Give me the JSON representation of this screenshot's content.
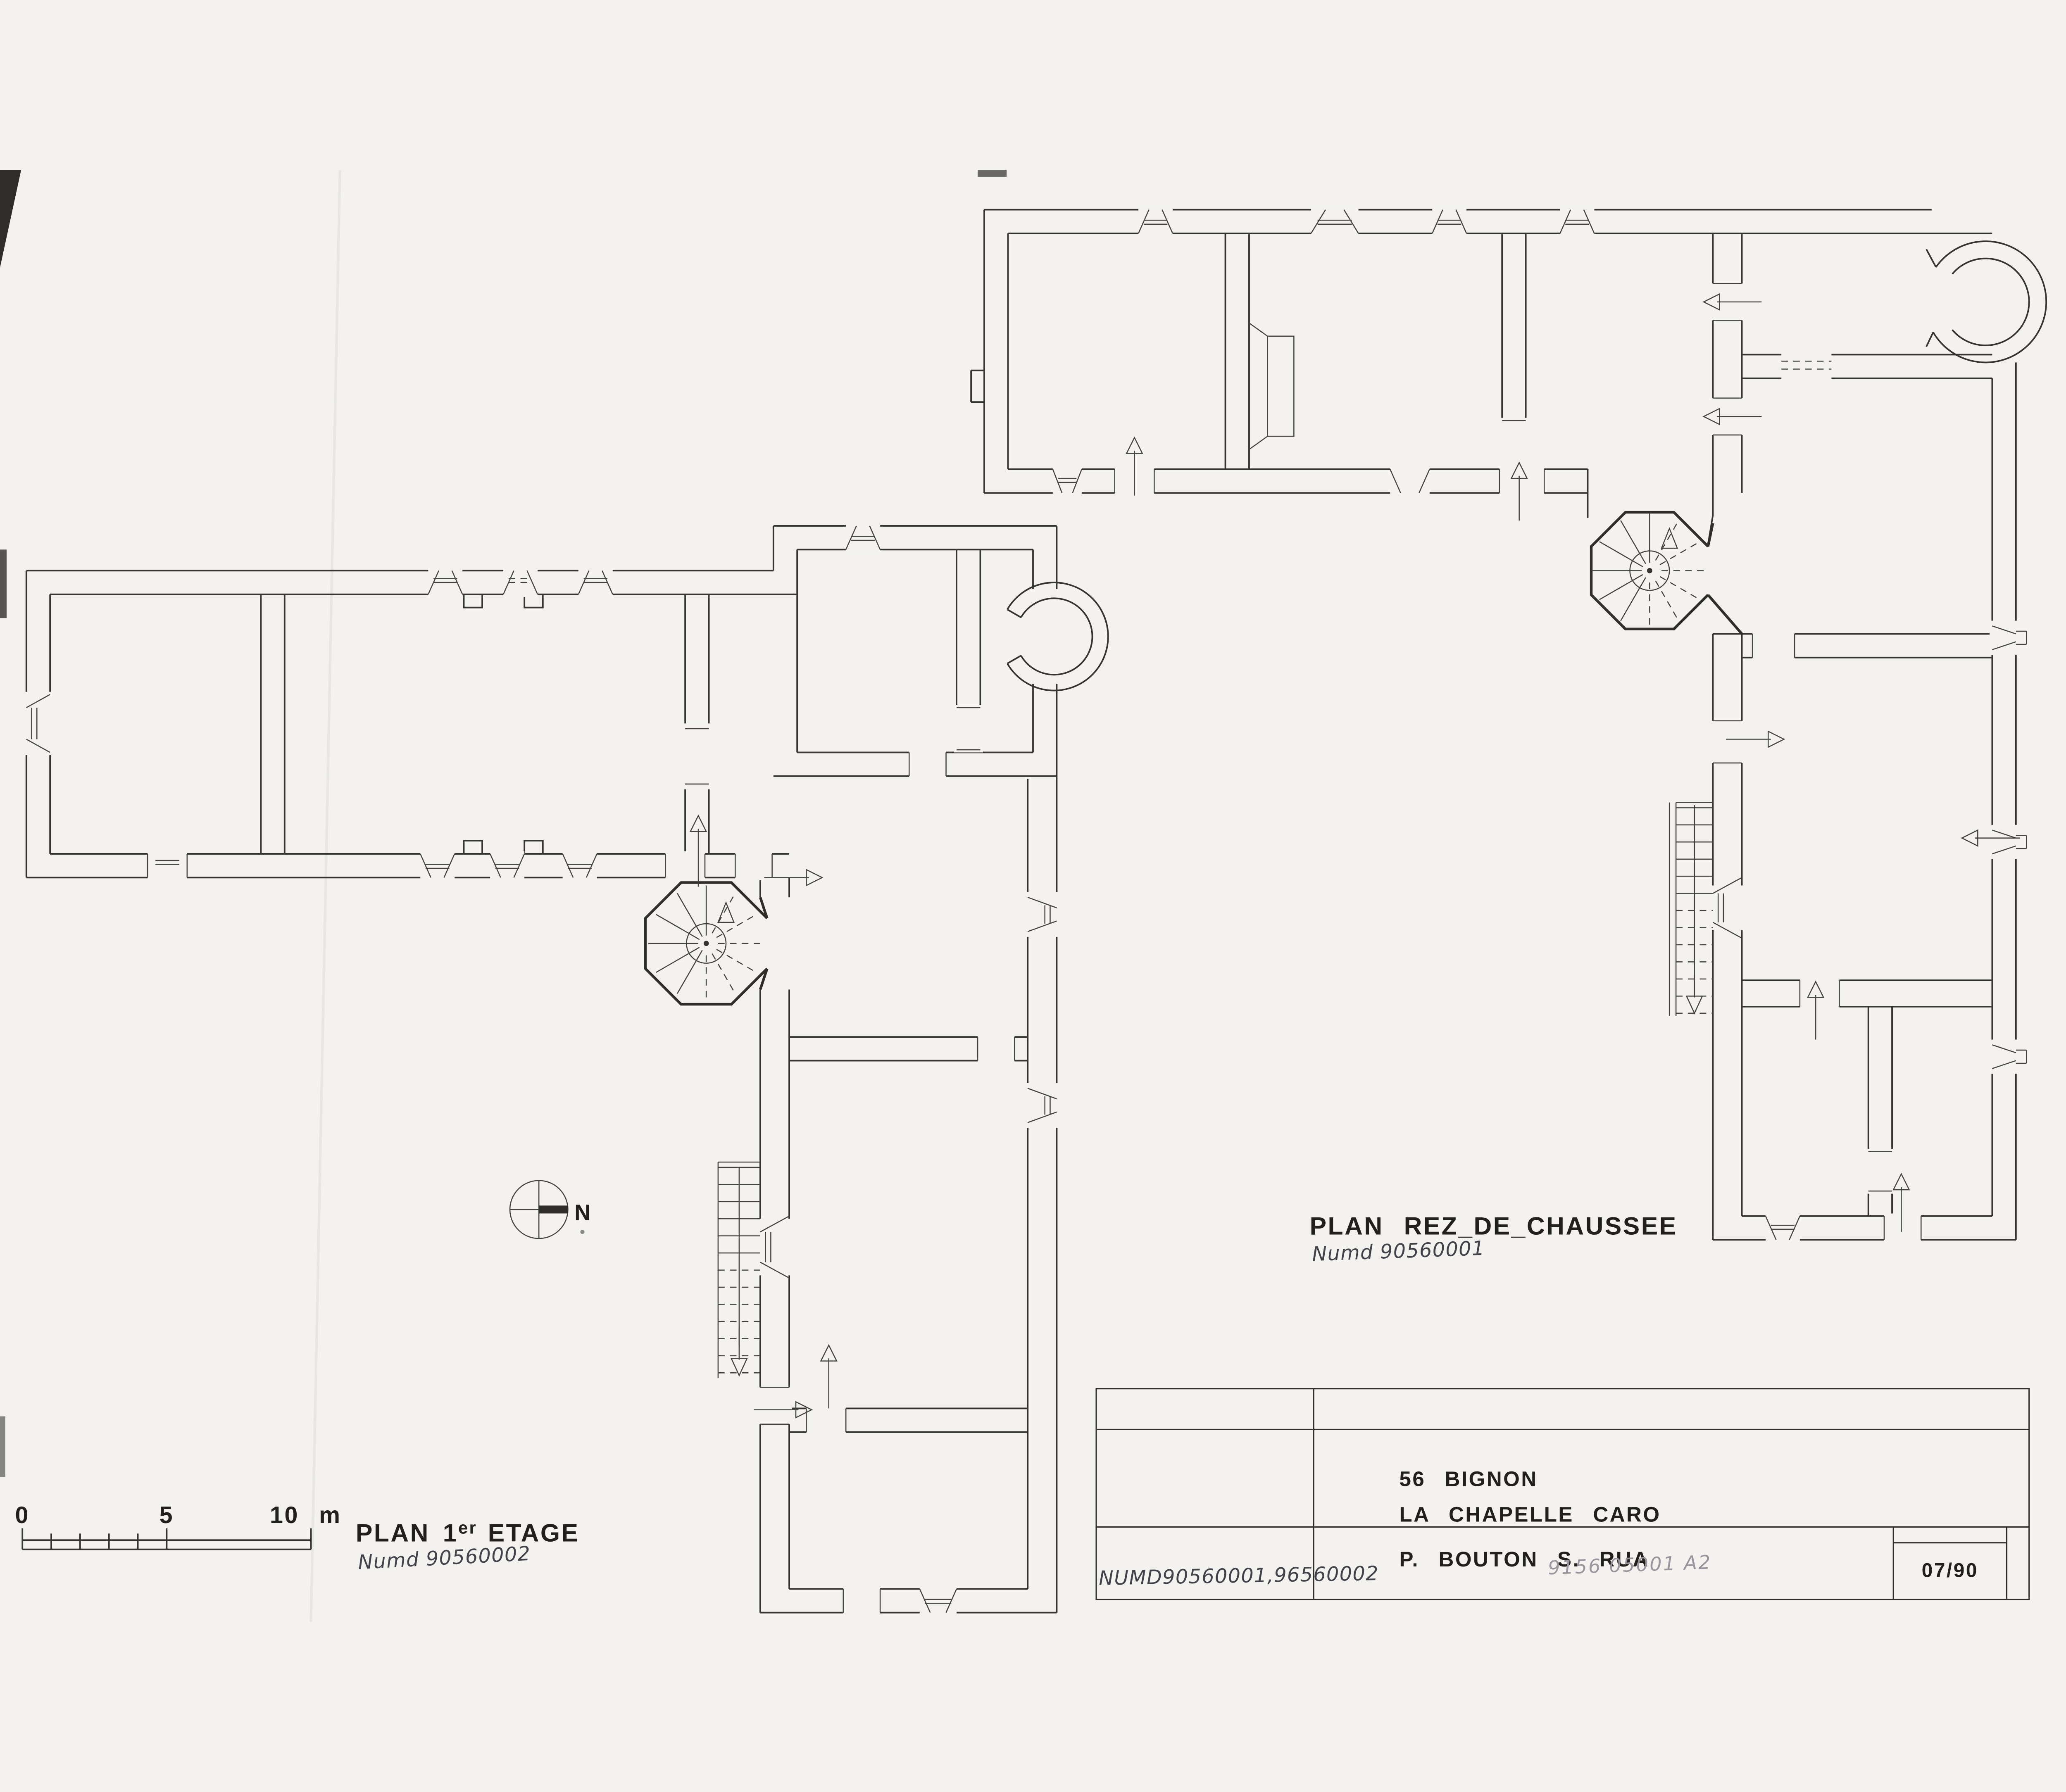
{
  "sheet": {
    "kind": "measured-survey-floor-plans"
  },
  "plan_first_floor": {
    "title_main": "PLAN",
    "title_num": "1",
    "title_sup": "er",
    "title_rest": "ETAGE",
    "handwritten_ref": "Numd 90560002"
  },
  "plan_ground_floor": {
    "title": "PLAN REZ_DE_CHAUSSEE",
    "handwritten_ref": "Numd 90560001"
  },
  "scale_bar": {
    "label_0": "0",
    "label_5": "5",
    "label_10": "10 m"
  },
  "compass": {
    "north_label": "N"
  },
  "title_block": {
    "line_location": "56 BIGNON",
    "line_commune": "LA CHAPELLE CARO",
    "line_authors": "P. BOUTON S. RUA",
    "date_box": "07/90",
    "handwritten_numbers": "NUMD90560001,96560002",
    "pencil_reference": "9156 05001 A2"
  },
  "colors": {
    "paper": "#f3f2ee",
    "ink": "#35342f",
    "stamp_ink": "#21201d",
    "handwriting": "#43424a",
    "pencil": "#98959c"
  }
}
